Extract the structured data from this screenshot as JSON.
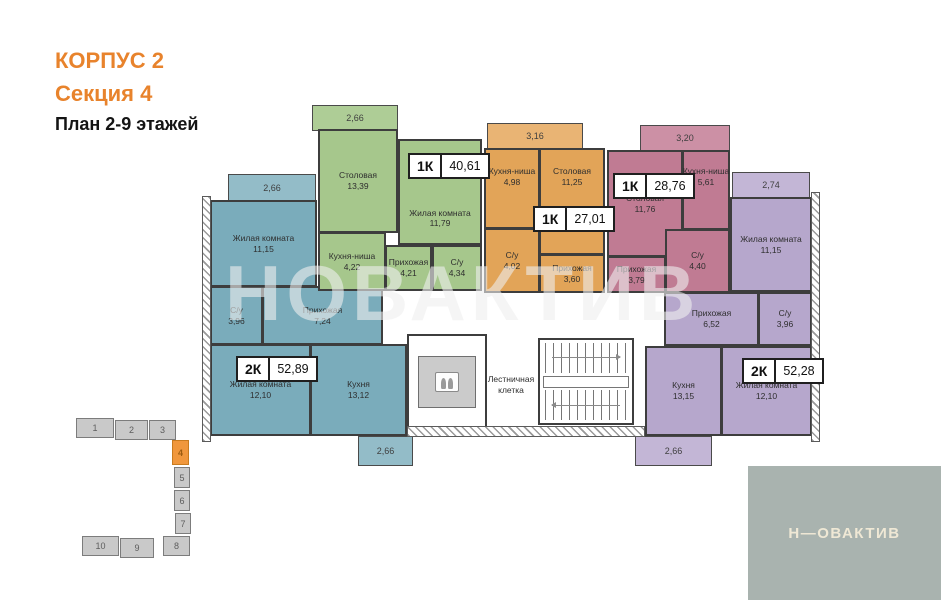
{
  "title": {
    "building": "КОРПУС 2",
    "section": "Секция 4",
    "plan": "План 2-9 этажей"
  },
  "watermark": "НОВАКТИВ",
  "logo": {
    "text": "Н—ОВАКТИВ"
  },
  "core": {
    "stairs_line1": "Лестничная",
    "stairs_line2": "клетка"
  },
  "dims": {
    "teal_top": "2,66",
    "green_top": "2,66",
    "orange_top": "3,16",
    "pink_top": "3,20",
    "purple_top": "2,74",
    "teal_bottom": "2,66",
    "purple_bottom": "2,66"
  },
  "apartments": {
    "teal": {
      "type": "2К",
      "total": "52,89",
      "room_top": {
        "name": "Жилая комната",
        "area": "11,15"
      },
      "su": {
        "name": "С/у",
        "area": "3,96"
      },
      "hall": {
        "name": "Прихожая",
        "area": "7,24"
      },
      "room_bottom": {
        "name": "Жилая комната",
        "area": "12,10"
      },
      "kitchen": {
        "name": "Кухня",
        "area": "13,12"
      }
    },
    "green": {
      "type": "1К",
      "total": "40,61",
      "dining": {
        "name": "Столовая",
        "area": "13,39"
      },
      "living": {
        "name": "Жилая комната",
        "area": "11,79"
      },
      "niche": {
        "name": "Кухня-ниша",
        "area": "4,22"
      },
      "hall": {
        "name": "Прихожая",
        "area": "4,21"
      },
      "su": {
        "name": "С/у",
        "area": "4,34"
      }
    },
    "orange": {
      "type": "1К",
      "total": "27,01",
      "niche": {
        "name": "Кухня-ниша",
        "area": "4,98"
      },
      "dining": {
        "name": "Столовая",
        "area": "11,25"
      },
      "su": {
        "name": "С/у",
        "area": "4,02"
      },
      "hall": {
        "name": "Прихожая",
        "area": "3,60"
      }
    },
    "pink": {
      "type": "1К",
      "total": "28,76",
      "dining": {
        "name": "Столовая",
        "area": "11,76"
      },
      "niche": {
        "name": "Кухня-ниша",
        "area": "5,61"
      },
      "su": {
        "name": "С/у",
        "area": "4,40"
      },
      "hall": {
        "name": "Прихожая",
        "area": "3,79"
      }
    },
    "purple": {
      "type": "2К",
      "total": "52,28",
      "room_top": {
        "name": "Жилая комната",
        "area": "11,15"
      },
      "su": {
        "name": "С/у",
        "area": "3,96"
      },
      "hall": {
        "name": "Прихожая",
        "area": "6,52"
      },
      "kitchen": {
        "name": "Кухня",
        "area": "13,15"
      },
      "room_bottom": {
        "name": "Жилая комната",
        "area": "12,10"
      }
    }
  },
  "minimap": {
    "sections": [
      "1",
      "2",
      "3",
      "4",
      "5",
      "6",
      "7",
      "8",
      "9",
      "10"
    ],
    "active": "4"
  },
  "colors": {
    "accent_orange": "#E8832C",
    "teal": "#7AACBB",
    "green": "#A6C78C",
    "orange": "#E2A458",
    "pink": "#C07B93",
    "purple": "#B6A7CC",
    "logo_bg": "#A9B3AF",
    "minimap_active": "#F0973C"
  }
}
